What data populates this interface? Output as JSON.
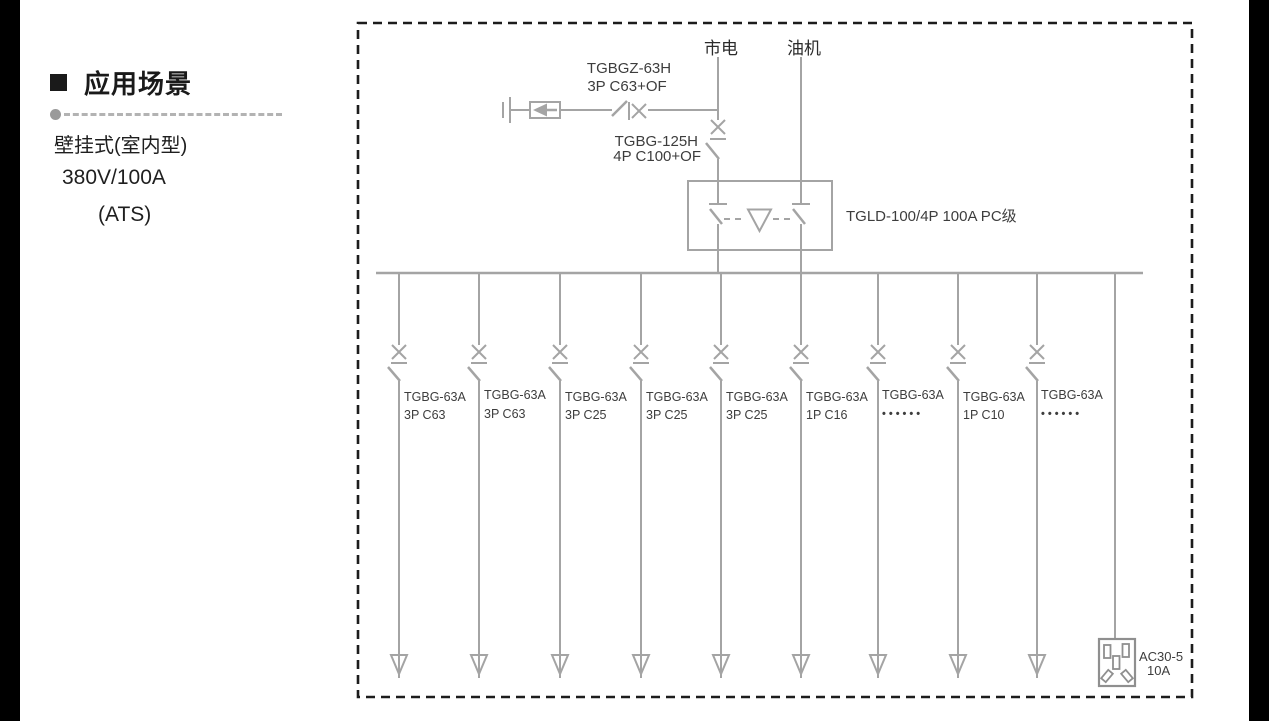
{
  "left_panel": {
    "section_title": "应用场景",
    "mount_type": "壁挂式(室内型)",
    "rating": "380V/100A",
    "system": "(ATS)"
  },
  "diagram": {
    "sources": {
      "mains_label": "市电",
      "generator_label": "油机"
    },
    "surge_branch": {
      "breaker_name": "TGBGZ-63H",
      "breaker_spec": "3P C63+OF"
    },
    "incoming_breaker": {
      "name": "TGBG-125H",
      "spec": "4P C100+OF"
    },
    "transfer_switch": {
      "label": "TGLD-100/4P 100A PC级"
    },
    "branches": [
      {
        "name": "TGBG-63A",
        "spec": "3P C63"
      },
      {
        "name": "TGBG-63A",
        "spec": "3P C63"
      },
      {
        "name": "TGBG-63A",
        "spec": "3P C25"
      },
      {
        "name": "TGBG-63A",
        "spec": "3P C25"
      },
      {
        "name": "TGBG-63A",
        "spec": "3P C25"
      },
      {
        "name": "TGBG-63A",
        "spec": "1P C16"
      },
      {
        "name": "TGBG-63A",
        "spec": "••••••"
      },
      {
        "name": "TGBG-63A",
        "spec": "1P C10"
      },
      {
        "name": "TGBG-63A",
        "spec": "••••••"
      }
    ],
    "socket": {
      "model": "AC30-5",
      "rating": "10A"
    }
  },
  "colors": {
    "diagram_line": "#a4a4a4",
    "border": "#1c1c1c",
    "label_text": "#3d3d3d",
    "heading_text": "#1a1a1a"
  }
}
